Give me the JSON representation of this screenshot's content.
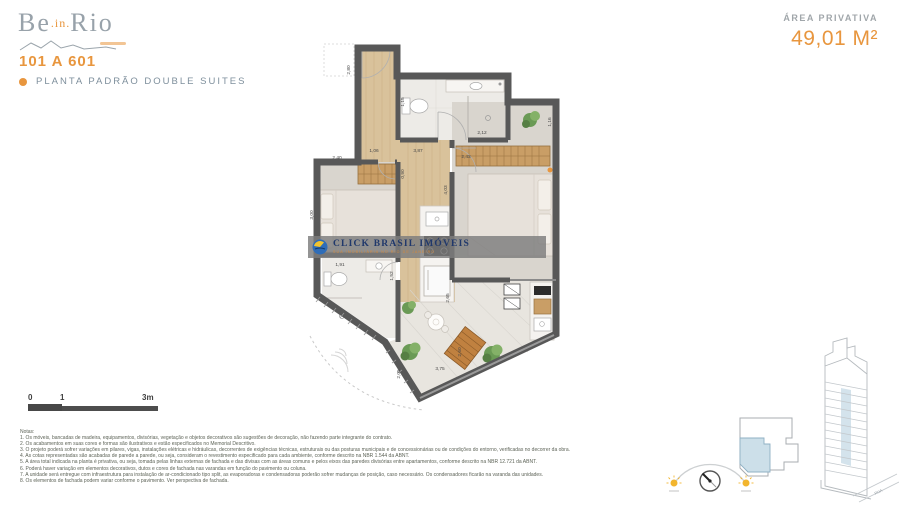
{
  "colors": {
    "accent": "#e8963e",
    "muted_blue_gray": "#7e8f9c",
    "wall": "#585858",
    "wood": "#d9c29b",
    "carpet": "#d9d5ce",
    "tile": "#edebe7",
    "unit_highlight": "#cfe0ea",
    "watermark_navy": "#20386b"
  },
  "logo": {
    "be": "Be",
    "in": ".in.",
    "rio": "Rio"
  },
  "header": {
    "units": "101 A 601",
    "plan_type": "PLANTA PADRÃO DOUBLE SUITES"
  },
  "area": {
    "label": "ÁREA PRIVATIVA",
    "value": "49,01 M²"
  },
  "watermark": {
    "title": "CLICK BRASIL IMÓVEIS",
    "subtitle": "SUA IMOBILIÁRIA NO RIO DE JANEIRO"
  },
  "plan": {
    "dims": [
      "2,80",
      "1,15",
      "2,12",
      "0,90",
      "1,06",
      "3,87",
      "2,40",
      "2,43",
      "4,03",
      "1,16",
      "3,00",
      "1,52",
      "1,91",
      "4,20",
      "2,65",
      "2,60",
      "2,05",
      "3,75"
    ]
  },
  "scale_bar": {
    "zero": "0",
    "one": "1",
    "three": "3m"
  },
  "minimap": {
    "street": "RUA"
  },
  "notes": {
    "title": "Notas:",
    "items": [
      "1. Os móveis, bancadas de madeira, equipamentos, divisórias, vegetação e objetos decorativos são sugestões de decoração, não fazendo parte integrante do contrato.",
      "2. Os acabamentos em suas cores e formas são ilustrativos e estão especificados no Memorial Descritivo.",
      "3. O projeto poderá sofrer variações em pilares, vigas, instalações elétricas e hidráulicas, decorrentes de exigências técnicas, estruturais ou das posturas municipais e de concessionárias ou de condições do entorno, verificadas no decorrer da obra.",
      "4. As cotas representadas são acabadas de parede a parede, ou seja, consideram o revestimento especificado para cada ambiente, conforme descrito na NBR 1.544 da ABNT.",
      "5. A área total indicada na planta é privativa, ou seja, tomada pelas linhas externas de fachada e das divisas com as áreas comuns e pelos eixos das paredes divisórias entre apartamentos, conforme descrito na NBR 12.721 da ABNT.",
      "6. Poderá haver variação em elementos decorativos, dutos e cores de fachada nas varandas em função do pavimento ou coluna.",
      "7. A unidade será entregue com infraestrutura para instalação de ar-condicionado tipo split, as evaporadoras e condensadoras poderão sofrer mudanças de posição, caso necessário. Os condensadores ficarão na varanda das unidades.",
      "8. Os elementos de fachada podem variar conforme o pavimento. Ver perspectiva de fachada."
    ]
  }
}
